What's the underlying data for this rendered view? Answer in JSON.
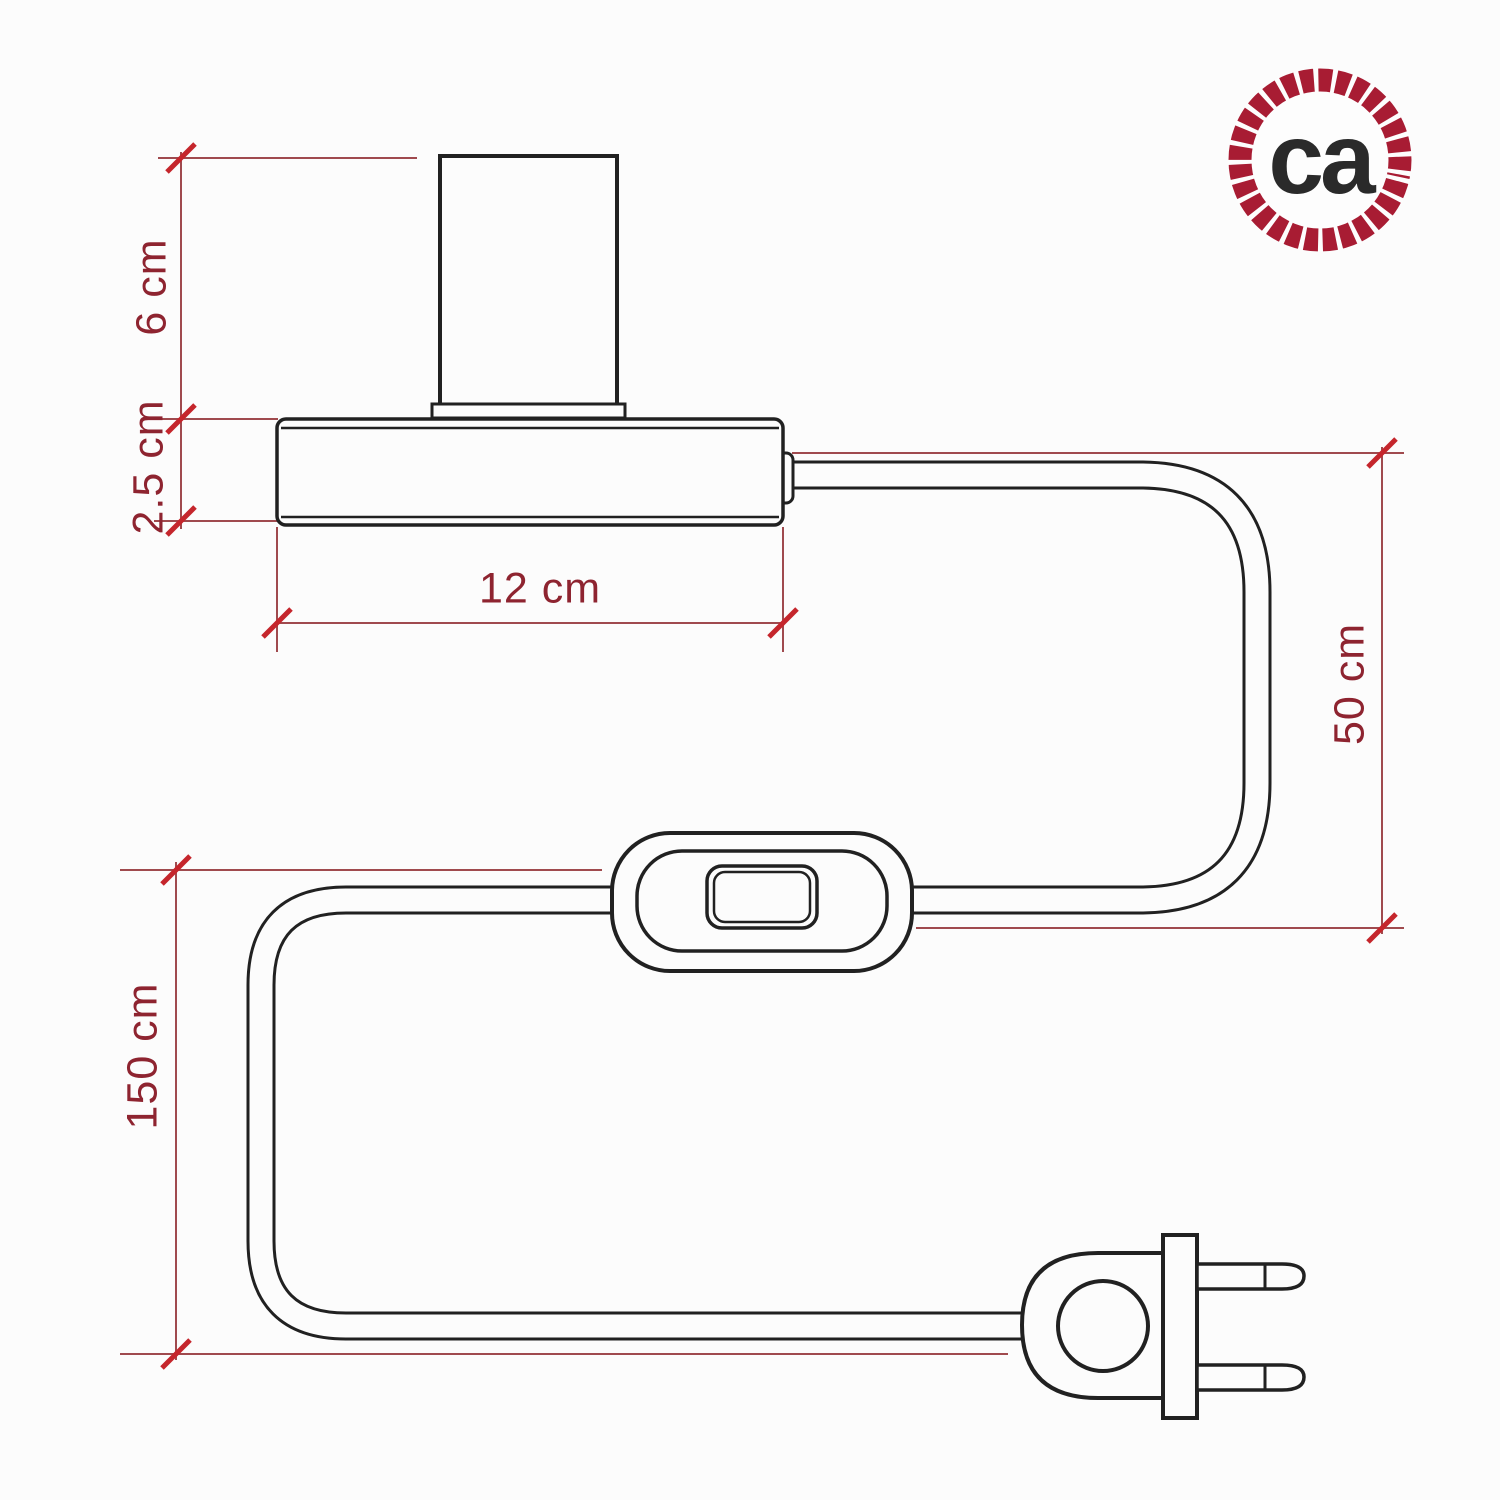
{
  "diagram": {
    "title": "table-lamp-with-cable-switch-and-plug-dimension-drawing",
    "dimension_labels": {
      "socket_height": "6 cm",
      "base_thickness": "2.5 cm",
      "base_width": "12 cm",
      "cable_base_to_switch": "50 cm",
      "cable_overall": "150 cm"
    },
    "colors": {
      "drawing_line": "#212121",
      "dimension_line": "#a04a4e",
      "tick": "#c5262c",
      "label_text": "#8e2430",
      "background": "#fcfcfc"
    }
  },
  "logo": {
    "text": "ca",
    "ring_color": "#a81c33",
    "text_color": "#2a2a2a"
  }
}
